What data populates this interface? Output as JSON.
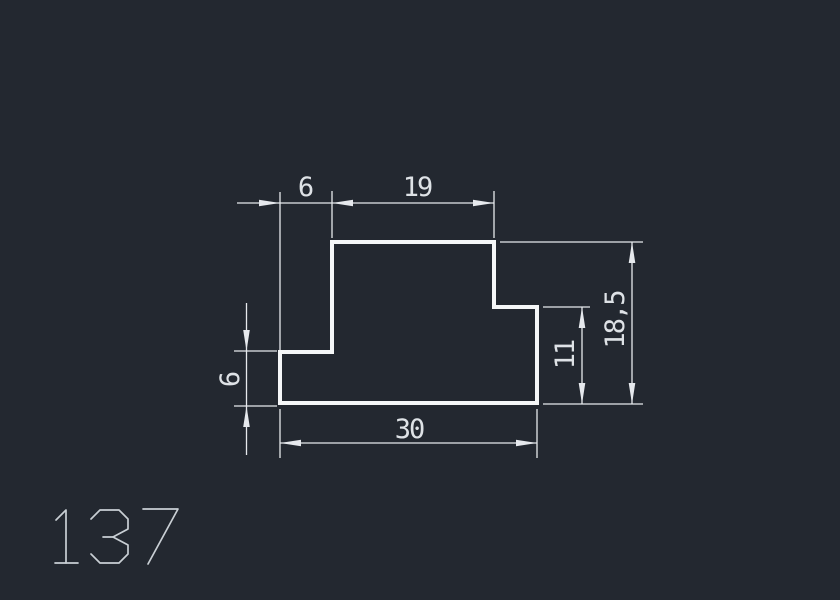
{
  "app": {
    "background": "#232830"
  },
  "drawing": {
    "part_number": "137",
    "profile": {
      "outline_points": "332,242 494,242 494,307 537,307 537,403 280,403 280,352 332,352",
      "stroke_color": "#f5f7f8",
      "stroke_width": 4
    },
    "dimensions": {
      "top_offset": "6",
      "top_width": "19",
      "bottom_width": "30",
      "right_step_height": "11",
      "total_height": "18,5",
      "left_step_height": "6"
    },
    "colors": {
      "dim_lines": "#e6e9ed",
      "dim_text": "#dee2e6",
      "part_number": "#c9cfd4"
    },
    "part_number_strokes": [
      [
        [
          56,
          520
        ],
        [
          66,
          510
        ],
        [
          66,
          563
        ]
      ],
      [
        [
          55,
          563
        ],
        [
          78,
          563
        ]
      ],
      [
        [
          91,
          519
        ],
        [
          100,
          510
        ],
        [
          119,
          510
        ],
        [
          128,
          519
        ],
        [
          128,
          529
        ],
        [
          113,
          537
        ],
        [
          103,
          537
        ]
      ],
      [
        [
          113,
          537
        ],
        [
          128,
          545
        ],
        [
          128,
          554
        ],
        [
          119,
          563
        ],
        [
          100,
          563
        ],
        [
          91,
          554
        ]
      ],
      [
        [
          143,
          509
        ],
        [
          178,
          509
        ],
        [
          148,
          564
        ]
      ]
    ]
  }
}
